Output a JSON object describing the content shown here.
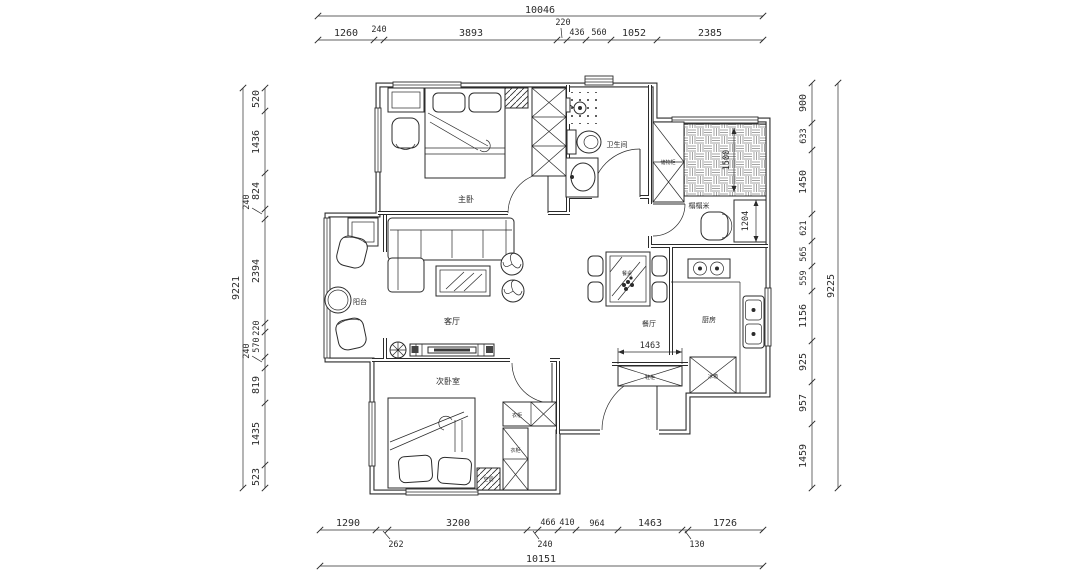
{
  "plan": {
    "colors": {
      "ink": "#2b2b2b",
      "paper": "#ffffff"
    },
    "dims": {
      "top": {
        "total": "10046",
        "segs": [
          "1260",
          "240",
          "3893",
          "220",
          "436",
          "560",
          "1052",
          "2385"
        ]
      },
      "bottom": {
        "total": "10151",
        "segs": [
          "1290",
          "262",
          "3200",
          "240",
          "466",
          "410",
          "964",
          "1463",
          "130",
          "1726"
        ]
      },
      "left": {
        "total": "9221",
        "segs": [
          "520",
          "1436",
          "824",
          "240",
          "2394",
          "220",
          "570",
          "240",
          "819",
          "1435",
          "523"
        ]
      },
      "right": {
        "total": "9225",
        "segs": [
          "900",
          "633",
          "1450",
          "621",
          "565",
          "559",
          "1156",
          "925",
          "957",
          "1459"
        ]
      },
      "inner": {
        "tatami_width": "1500",
        "nook_depth": "1204",
        "entry_cabinet": "1463"
      }
    },
    "rooms": {
      "master": "主卧",
      "bath": "卫生间",
      "tatami": "榻榻米",
      "balcony": "阳台",
      "living": "客厅",
      "dining": "餐厅",
      "kitchen": "厨房",
      "bedroom2": "次卧室"
    },
    "labels": {
      "storage": "储物柜",
      "shoe_cabinet": "鞋柜",
      "fridge": "冰箱",
      "wardrobe_a": "衣柜",
      "wardrobe_b": "衣柜",
      "dining_table": "餐桌",
      "ac": "空调"
    }
  }
}
